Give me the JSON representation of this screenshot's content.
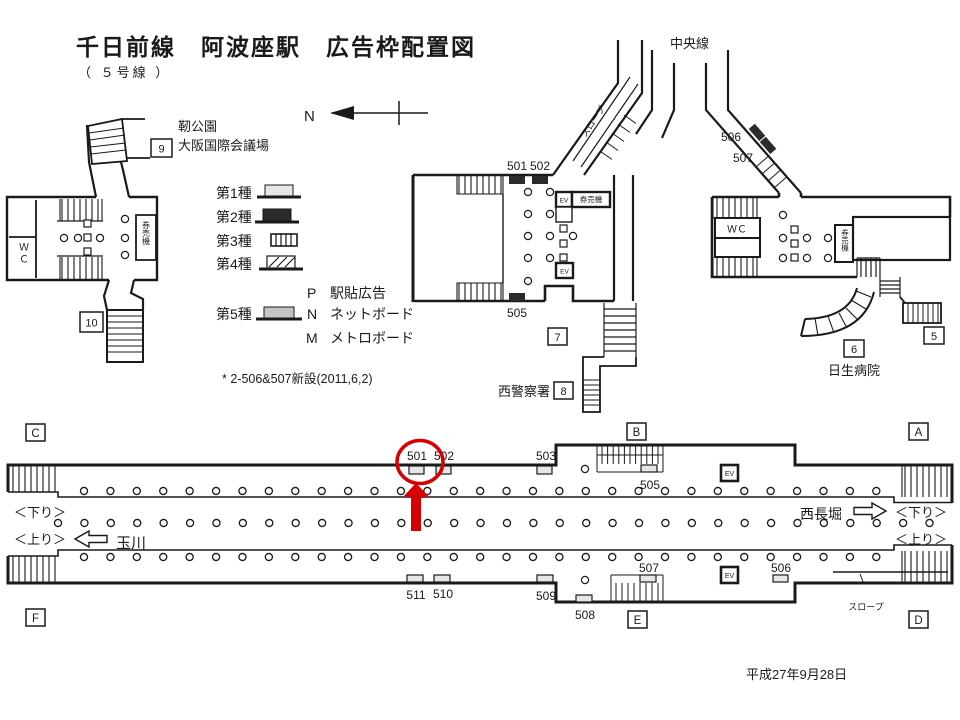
{
  "title": "千日前線　阿波座駅　広告枠配置図",
  "subtitle": "（ ５号線 ）",
  "compass": {
    "north": "N"
  },
  "legend": {
    "type1": "第1種",
    "type2": "第2種",
    "type3": "第3種",
    "type4": "第4種",
    "type5": "第5種",
    "p_code": "P",
    "p_label": "駅貼広告",
    "n_code": "N",
    "n_label": "ネットボード",
    "m_code": "M",
    "m_label": "メトロボード",
    "note": "* 2-506&507新設(2011,6,2)"
  },
  "west": {
    "exit9": "9",
    "exit10": "10",
    "landmark_line1": "靭公園",
    "landmark_line2": "大阪国際会議場",
    "wc": "ＷＣ",
    "ticket": "券売機"
  },
  "center": {
    "ad501": "501",
    "ad502": "502",
    "ad505": "505",
    "ev_upper": "EV",
    "ev_lower": "EV",
    "ticket": "券売機",
    "slope": "スロープ",
    "exit7": "7",
    "exit8": "8",
    "police": "西警察署",
    "chuo_line": "中央線"
  },
  "east": {
    "ad506": "506",
    "ad507": "507",
    "wc": "ＷＣ",
    "ticket": "券売機",
    "exit5": "5",
    "exit6": "6",
    "hospital": "日生病院"
  },
  "platform": {
    "corner_a": "A",
    "corner_b": "B",
    "corner_c": "C",
    "corner_d": "D",
    "corner_e": "E",
    "corner_f": "F",
    "ad501": "501",
    "ad502": "502",
    "ad503": "503",
    "ad505": "505",
    "ad506": "506",
    "ad507": "507",
    "ad508": "508",
    "ad509": "509",
    "ad510": "510",
    "ad511": "511",
    "ev_upper": "EV",
    "ev_lower": "EV",
    "down_left": "＜下り＞",
    "up_left": "＜上り＞",
    "down_right": "＜下り＞",
    "up_right": "＜上り＞",
    "tamagawa": "玉川",
    "nishinagahori": "西長堀",
    "slope": "スロープ"
  },
  "date": "平成27年9月28日",
  "colors": {
    "line": "#1a1a1a",
    "ad_light": "#e6e6e6",
    "ad_dark": "#2b2b2b",
    "ad_mid": "#c4c4c4",
    "highlight_red": "#d60000"
  }
}
